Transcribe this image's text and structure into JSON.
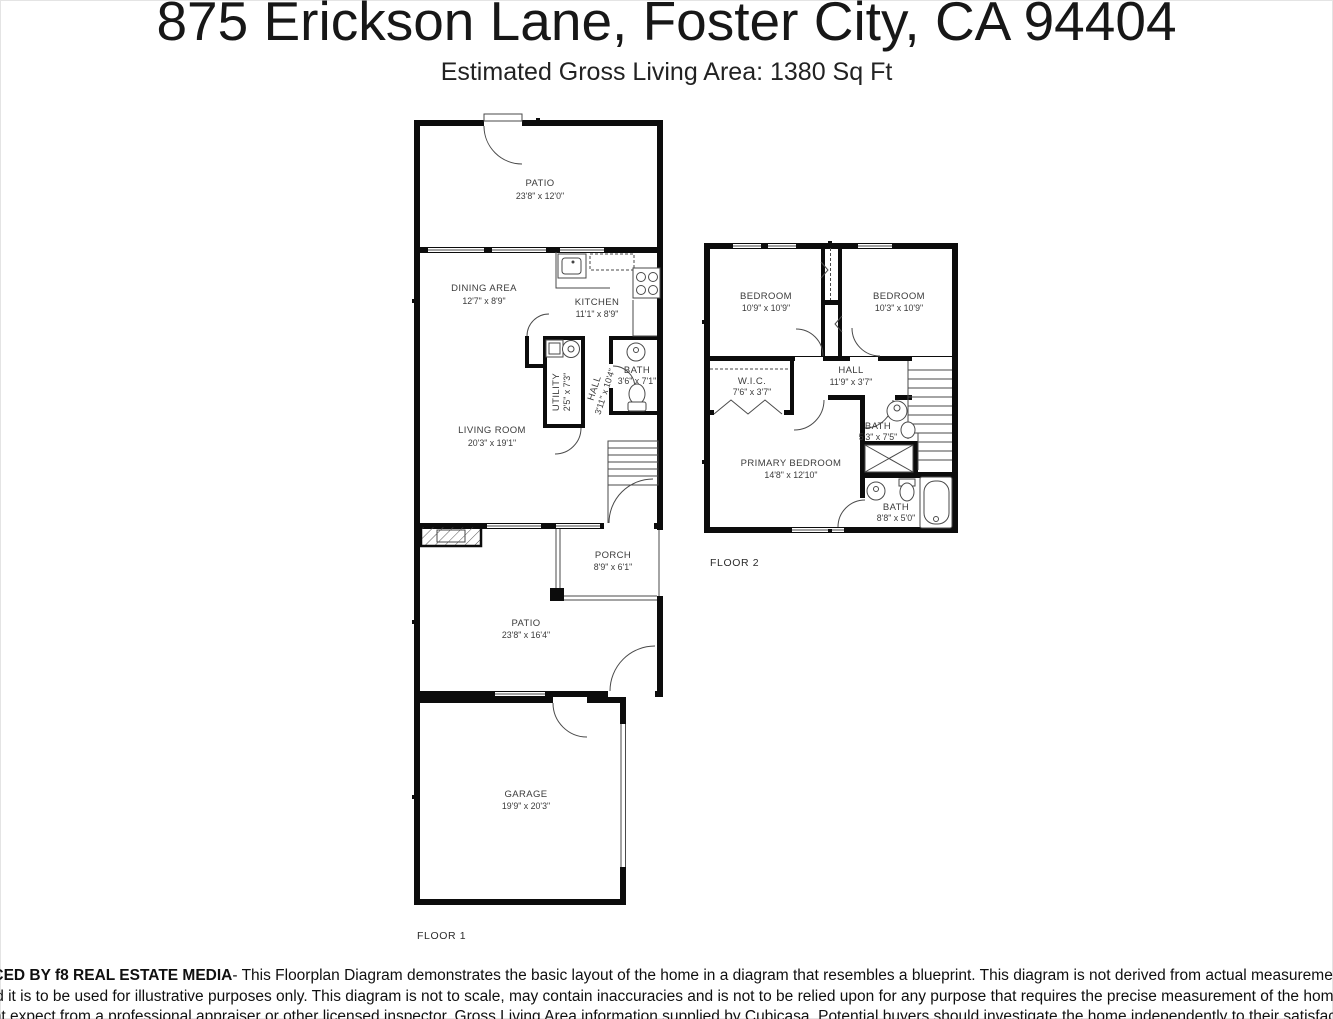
{
  "header": {
    "title": "875 Erickson Lane, Foster City, CA 94404",
    "subtitle": "Estimated Gross Living Area: 1380 Sq Ft"
  },
  "floor1": {
    "label": "FLOOR 1",
    "rooms": {
      "patio_top": {
        "name": "PATIO",
        "dims": "23'8\" x 12'0\""
      },
      "dining": {
        "name": "DINING AREA",
        "dims": "12'7\" x 8'9\""
      },
      "kitchen": {
        "name": "KITCHEN",
        "dims": "11'1\" x 8'9\""
      },
      "utility": {
        "name": "UTILITY",
        "dims": "2'5\" x 7'3\""
      },
      "hall": {
        "name": "HALL",
        "dims": "3'11\" x 10'4\""
      },
      "bath": {
        "name": "BATH",
        "dims": "3'6\" x 7'1\""
      },
      "living": {
        "name": "LIVING ROOM",
        "dims": "20'3\" x 19'1\""
      },
      "porch": {
        "name": "PORCH",
        "dims": "8'9\" x 6'1\""
      },
      "patio_bottom": {
        "name": "PATIO",
        "dims": "23'8\" x 16'4\""
      },
      "garage": {
        "name": "GARAGE",
        "dims": "19'9\" x 20'3\""
      }
    }
  },
  "floor2": {
    "label": "FLOOR 2",
    "rooms": {
      "bedroom_left": {
        "name": "BEDROOM",
        "dims": "10'9\" x 10'9\""
      },
      "bedroom_right": {
        "name": "BEDROOM",
        "dims": "10'3\" x 10'9\""
      },
      "wic": {
        "name": "W.I.C.",
        "dims": "7'6\" x 3'7\""
      },
      "hall": {
        "name": "HALL",
        "dims": "11'9\" x 3'7\""
      },
      "bath_upper": {
        "name": "BATH",
        "dims": "5'3\" x 7'5\""
      },
      "primary": {
        "name": "PRIMARY BEDROOM",
        "dims": "14'8\" x 12'10\""
      },
      "bath_lower": {
        "name": "BATH",
        "dims": "8'8\" x 5'0\""
      }
    }
  },
  "footer": {
    "bold": "PRODUCED BY f8 REAL ESTATE MEDIA",
    "line1_rest": " - This Floorplan Diagram demonstrates the basic layout of the home in a diagram that resembles a blueprint. This diagram is not derived from actual measurements of the",
    "line2": "home, and it is to be used for illustrative purposes only. This diagram is not to scale, may contain inaccuracies and is not to be relied upon for any purpose that requires the precise measurement of the home that one",
    "line3": "might expect from a professional appraiser or other licensed inspector. Gross Living Area information supplied by Cubicasa. Potential buyers should investigate the home independently to their satisfaction."
  },
  "colors": {
    "wall": "#0c0c0c",
    "background": "#ffffff",
    "text": "#3b3b3b"
  }
}
